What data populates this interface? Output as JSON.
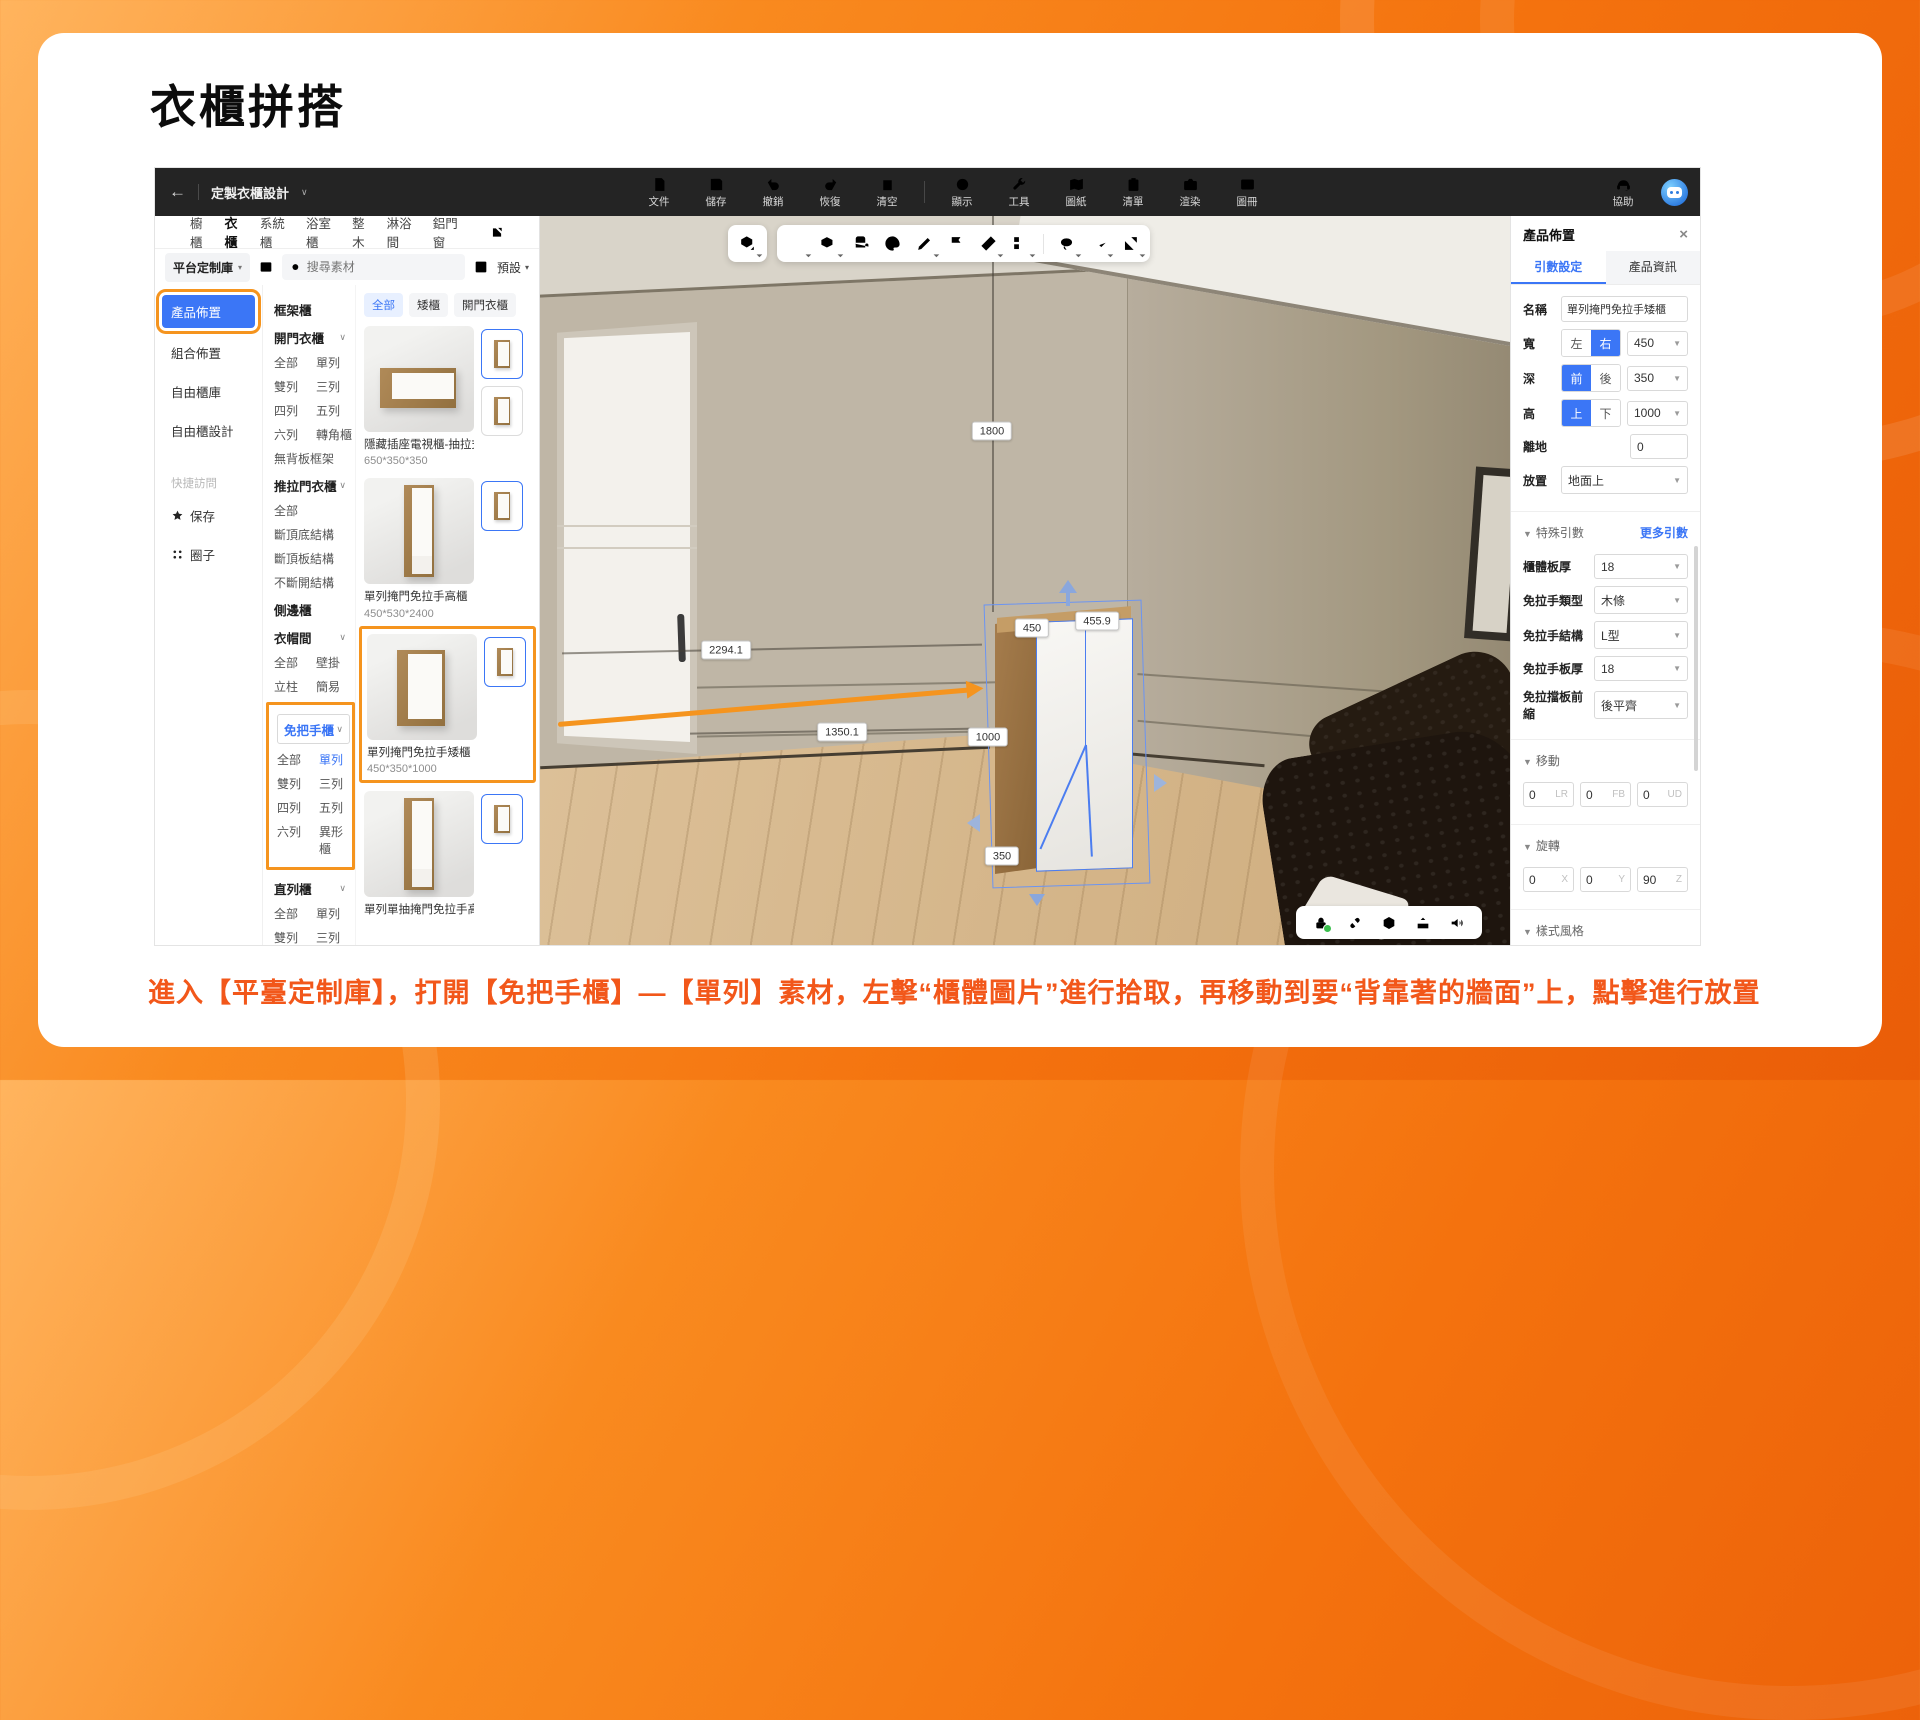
{
  "page": {
    "title": "衣櫃拼搭",
    "caption": "進入【平臺定制庫】，打開【免把手櫃】—【單列】素材，左擊“櫃體圖片”進行拾取，再移動到要“背靠著的牆面”上，點擊進行放置"
  },
  "topbar": {
    "doc_title": "定製衣櫃設計",
    "items": [
      {
        "label": "文件"
      },
      {
        "label": "儲存"
      },
      {
        "label": "撤銷"
      },
      {
        "label": "恢復"
      },
      {
        "label": "清空"
      },
      {
        "label": "顯示"
      },
      {
        "label": "工具"
      },
      {
        "label": "圖紙"
      },
      {
        "label": "清單"
      },
      {
        "label": "渲染"
      },
      {
        "label": "圖冊"
      }
    ],
    "help_label": "協助"
  },
  "library": {
    "tabs": [
      {
        "label": "櫥櫃"
      },
      {
        "label": "衣櫃"
      },
      {
        "label": "系統櫃"
      },
      {
        "label": "浴室櫃"
      },
      {
        "label": "整木"
      },
      {
        "label": "淋浴間"
      },
      {
        "label": "鋁門窗"
      }
    ],
    "source_select": "平台定制庫",
    "search_placeholder": "搜尋素材",
    "preset_label": "預設",
    "nav": {
      "items": [
        {
          "label": "產品佈置"
        },
        {
          "label": "組合佈置"
        },
        {
          "label": "自由櫃庫"
        },
        {
          "label": "自由櫃設計"
        }
      ],
      "quick_label": "快捷訪問",
      "save_label": "保存",
      "circle_label": "圈子"
    },
    "categories": [
      {
        "title": "框架櫃"
      },
      {
        "title": "開門衣櫃",
        "rows": [
          [
            "全部",
            "單列"
          ],
          [
            "雙列",
            "三列"
          ],
          [
            "四列",
            "五列"
          ],
          [
            "六列",
            "轉角櫃"
          ],
          [
            "無背板框架"
          ]
        ]
      },
      {
        "title": "推拉門衣櫃",
        "rows": [
          [
            "全部"
          ],
          [
            "斷頂底結構"
          ],
          [
            "斷頂板結構"
          ],
          [
            "不斷開結構"
          ]
        ]
      },
      {
        "title": "側邊櫃"
      },
      {
        "title": "衣帽間",
        "rows": [
          [
            "全部",
            "壁掛"
          ],
          [
            "立柱",
            "簡易"
          ]
        ]
      },
      {
        "title": "免把手櫃",
        "rows": [
          [
            "全部",
            "單列"
          ],
          [
            "雙列",
            "三列"
          ],
          [
            "四列",
            "五列"
          ],
          [
            "六列",
            "異形櫃"
          ]
        ]
      },
      {
        "title": "直列櫃",
        "rows": [
          [
            "全部",
            "單列"
          ],
          [
            "雙列",
            "三列"
          ],
          [
            "四列",
            "五列"
          ],
          [
            "六列",
            "切角框架"
          ],
          [
            "切角"
          ]
        ]
      }
    ],
    "collapse_label": "全部收起",
    "chips": [
      {
        "label": "全部"
      },
      {
        "label": "矮櫃"
      },
      {
        "label": "開門衣櫃"
      }
    ],
    "products": [
      {
        "name": "隱藏插座電視櫃-抽拉式",
        "size": "650*350*350"
      },
      {
        "name": "單列掩門免拉手高櫃",
        "size": "450*530*2400"
      },
      {
        "name": "單列掩門免拉手矮櫃",
        "size": "450*350*1000"
      },
      {
        "name": "單列單抽掩門免拉手高櫃",
        "size": ""
      }
    ]
  },
  "viewport": {
    "dims": [
      "1800",
      "2294.1",
      "1350.1",
      "450",
      "455.9",
      "1000",
      "350"
    ]
  },
  "inspector": {
    "title": "產品佈置",
    "tab_params": "引數設定",
    "tab_info": "產品資訊",
    "name_label": "名稱",
    "name_value": "單列掩門免拉手矮櫃",
    "width_label": "寬",
    "width_seg": [
      "左",
      "右"
    ],
    "width_value": "450",
    "depth_label": "深",
    "depth_seg": [
      "前",
      "後"
    ],
    "depth_value": "350",
    "height_label": "高",
    "height_seg": [
      "上",
      "下"
    ],
    "height_value": "1000",
    "offground_label": "離地",
    "offground_value": "0",
    "place_label": "放置",
    "place_value": "地面上",
    "special_label": "特殊引數",
    "more_label": "更多引數",
    "params": [
      {
        "label": "櫃體板厚",
        "value": "18"
      },
      {
        "label": "免拉手類型",
        "value": "木條"
      },
      {
        "label": "免拉手結構",
        "value": "L型"
      },
      {
        "label": "免拉手板厚",
        "value": "18"
      },
      {
        "label": "免拉擋板前縮",
        "value": "後平齊"
      }
    ],
    "move_label": "移動",
    "move": [
      {
        "v": "0",
        "axis": "LR"
      },
      {
        "v": "0",
        "axis": "FB"
      },
      {
        "v": "0",
        "axis": "UD"
      }
    ],
    "rotate_label": "旋轉",
    "rotate": [
      {
        "v": "0",
        "axis": "X"
      },
      {
        "v": "0",
        "axis": "Y"
      },
      {
        "v": "90",
        "axis": "Z"
      }
    ],
    "style_label": "樣式風格",
    "material_label": "材質",
    "material_name": "丁香楓木—啞光",
    "material_base": "主基材：顆粒板",
    "body_style_label": "櫃體樣式",
    "body_style_name": "單列掩門免拉手矮櫃",
    "buttons": [
      "門板安裝",
      "背板安裝",
      "抽屜安裝",
      "拉伸改尺",
      "左右映象",
      "封板安裝"
    ],
    "beta": "Beta"
  },
  "colors": {
    "accent_blue": "#3b76f6",
    "annotation_orange": "#f5941e",
    "caption_orange": "#f2571a",
    "topbar_bg": "#242424"
  }
}
